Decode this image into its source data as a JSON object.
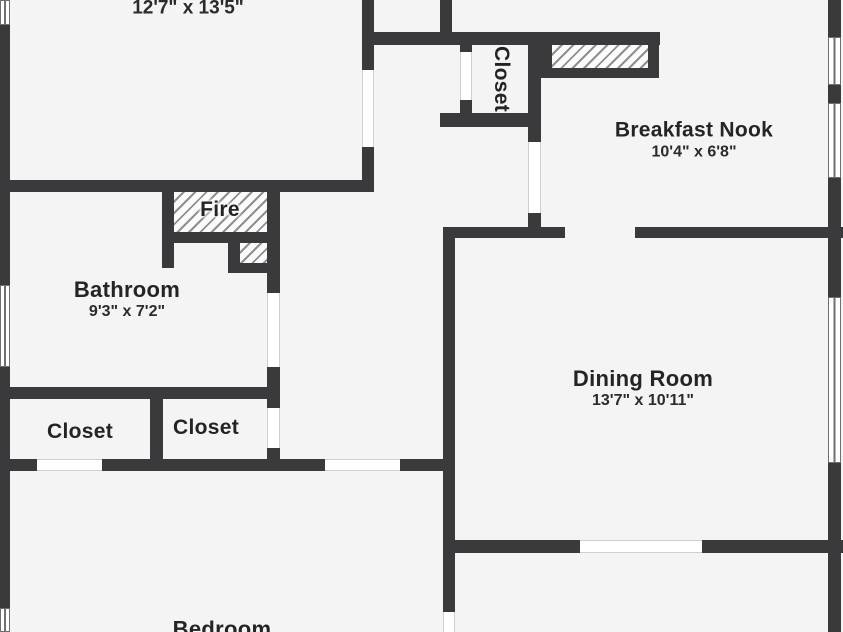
{
  "plan": {
    "background_color": "#f4f4f4",
    "wall_color": "#3a3a3c",
    "labels": {
      "top_left_room": {
        "dims": "12'7\" x 13'5\""
      },
      "closet_top": {
        "name": "Closet"
      },
      "breakfast_nook": {
        "name": "Breakfast Nook",
        "dims": "10'4\" x 6'8\""
      },
      "fireplace": {
        "name": "Fire"
      },
      "bathroom": {
        "name": "Bathroom",
        "dims": "9'3\" x 7'2\""
      },
      "closet_left": {
        "name": "Closet"
      },
      "closet_middle": {
        "name": "Closet"
      },
      "dining_room": {
        "name": "Dining Room",
        "dims": "13'7\" x 10'11\""
      },
      "bedroom": {
        "name": "Bedroom"
      }
    }
  }
}
